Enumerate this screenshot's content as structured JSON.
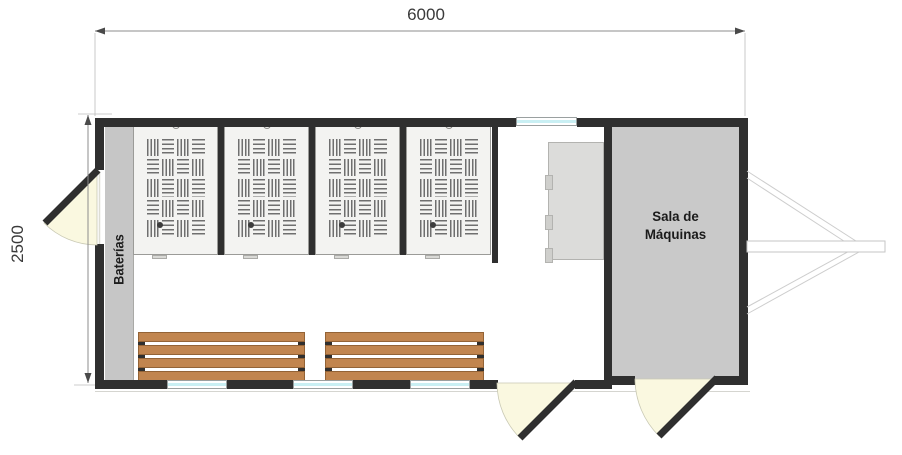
{
  "dimensions": {
    "width_label": "6000",
    "height_label": "2500"
  },
  "rooms": {
    "batteries_label": "Baterías",
    "machine_room_line1": "Sala de",
    "machine_room_line2": "Máquinas"
  },
  "fixtures": {
    "locker_count": 4,
    "bench_count": 2,
    "bench_slat_count": 4,
    "bottom_window_count": 3,
    "top_window_count": 1,
    "door_count": 3,
    "cabinet_count": 1
  },
  "colors": {
    "wall": "#2f2f2f",
    "machine_room_fill": "#c9c9c9",
    "batteries_strip_fill": "#c6c6c6",
    "locker_fill": "#f3f3f1",
    "locker_hatch_line": "#6f6f6f",
    "bench_wood": "#c1854f",
    "door_swing_fill": "#faf8e0",
    "window_glass": "#c9eff3",
    "cabinet_fill": "#dcdcda",
    "dimension_text": "#3a3a3a",
    "hitch_line": "#cdcdcd"
  }
}
